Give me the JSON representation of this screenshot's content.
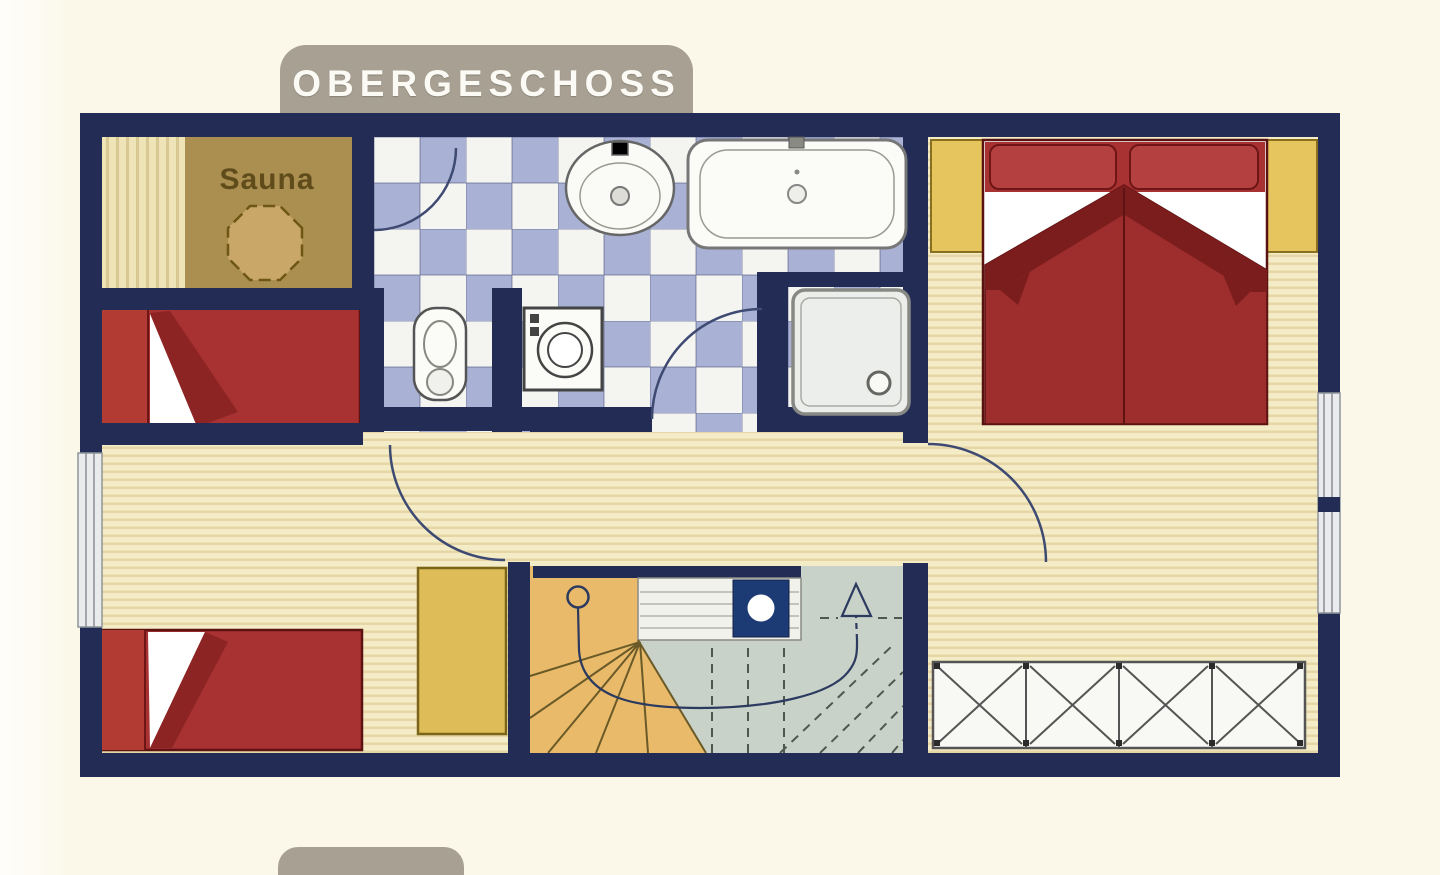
{
  "title": "OBERGESCHOSS",
  "labels": {
    "sauna": "Sauna"
  },
  "rooms": [
    {
      "name": "sauna"
    },
    {
      "name": "bathroom"
    },
    {
      "name": "bedroom-left-top"
    },
    {
      "name": "bedroom-left-bottom"
    },
    {
      "name": "bedroom-right"
    },
    {
      "name": "hallway"
    },
    {
      "name": "staircase"
    }
  ],
  "fixtures": [
    "sauna-stove",
    "sauna-bench",
    "bathtub",
    "sink",
    "toilet",
    "washing-machine",
    "shower",
    "single-bed",
    "single-bed",
    "double-bed",
    "nightstand",
    "nightstand",
    "cabinet",
    "wardrobe",
    "winder-stairs",
    "chimney",
    "stair-direction-arrow",
    "door-swing-arc",
    "window"
  ],
  "colors": {
    "background": "#fbf8ea",
    "tab_gray": "#a8a193",
    "wall_navy": "#222c55",
    "wood_floor": "#f4ecc6",
    "wood_stripe": "#e6d6a6",
    "tile_blue": "#a9b2d5",
    "tile_white": "#f4f4f1",
    "sauna_brown": "#aa8f51",
    "bed_red": "#a83131",
    "bed_fold_red": "#8c2424",
    "furniture_yellow": "#debd58",
    "stair_tan": "#e8ba6a",
    "stair_gray": "#c8d2c8",
    "chimney_navy": "#1c3a74",
    "fixture_white": "#fbfbf8",
    "door_arc_line": "#3e4a72"
  }
}
